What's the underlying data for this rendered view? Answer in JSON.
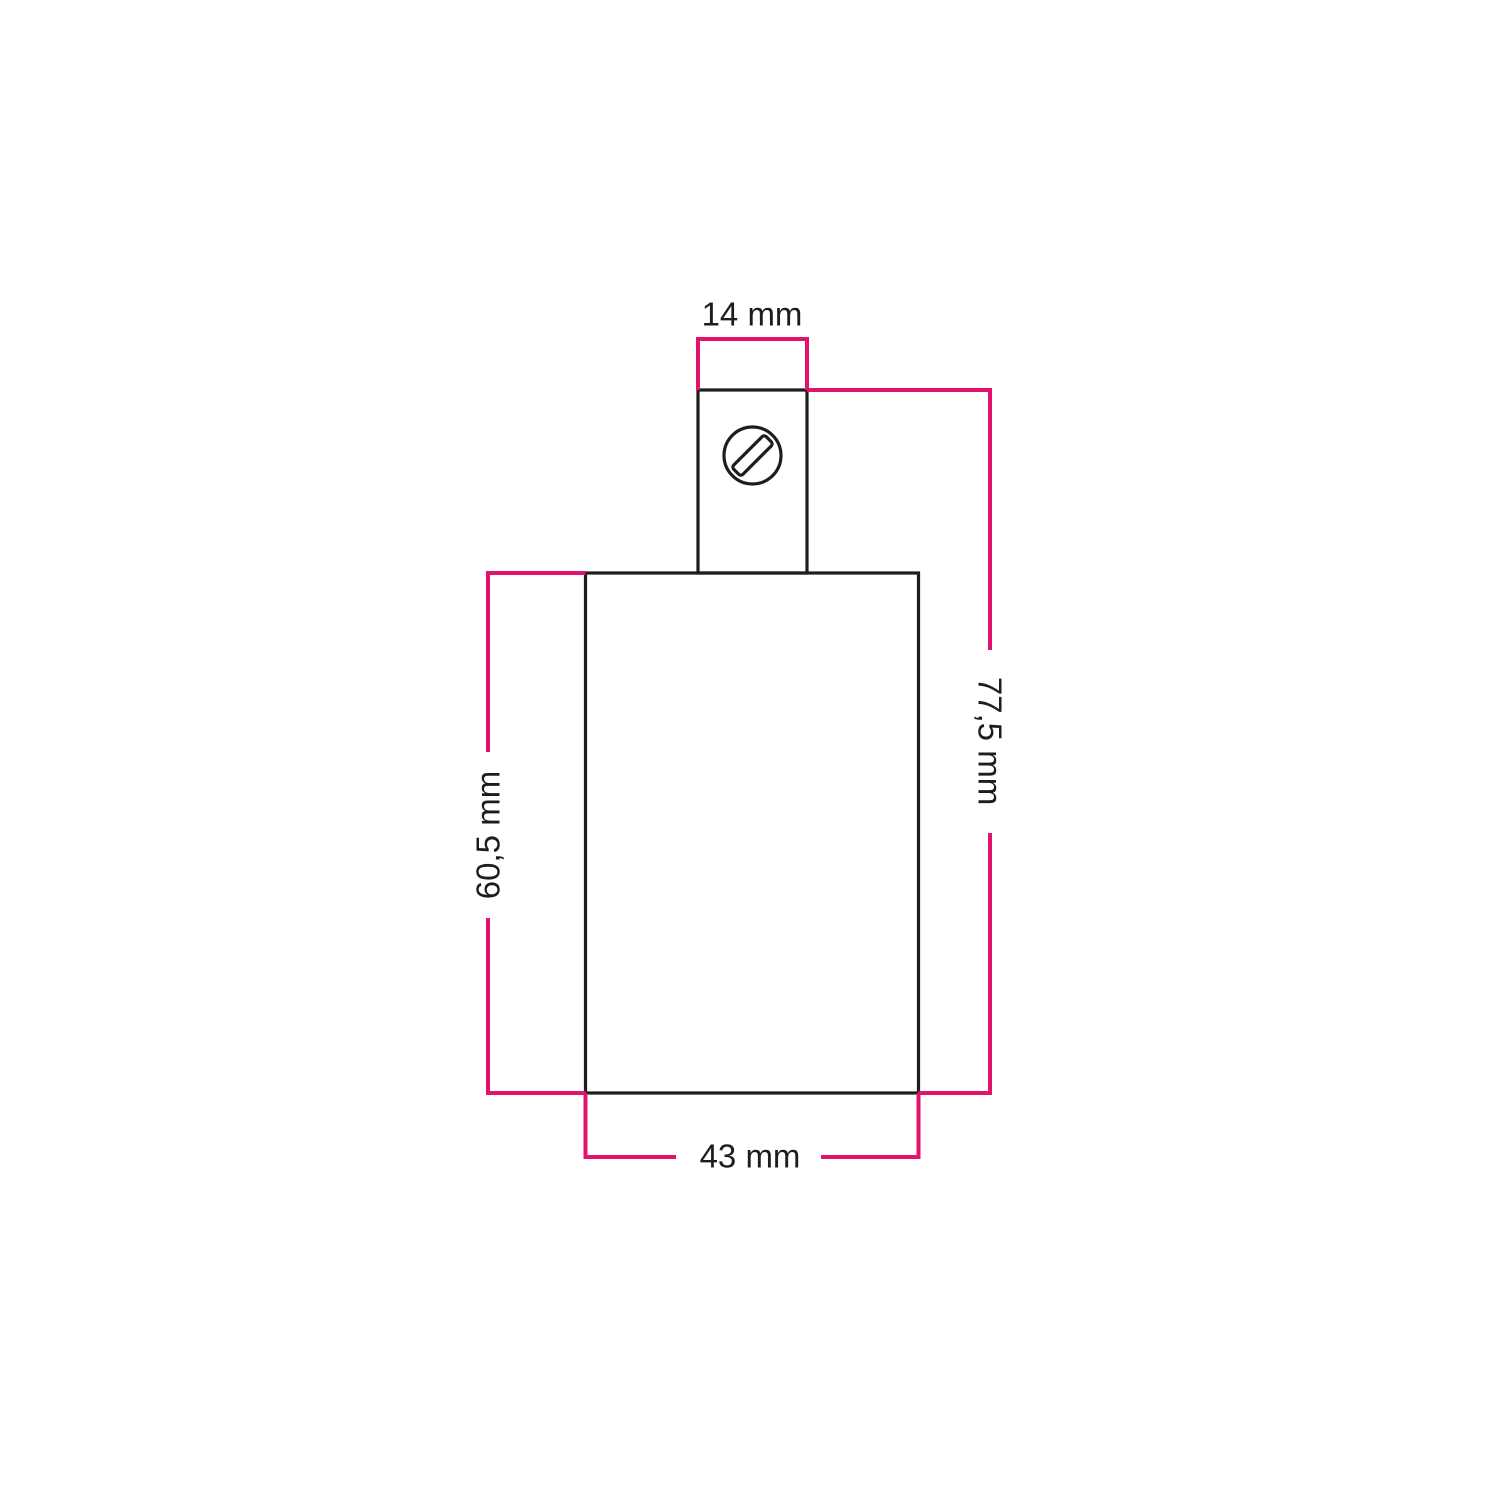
{
  "colors": {
    "background": "#ffffff",
    "outline": "#1d1d1b",
    "dimension": "#e3126f",
    "text": "#1d1d1b"
  },
  "labels": {
    "neck_width": "14 mm",
    "overall_height": "77,5 mm",
    "body_height": "60,5 mm",
    "body_width": "43 mm"
  },
  "icons": {
    "screw": "slotted-screw-head-icon"
  }
}
